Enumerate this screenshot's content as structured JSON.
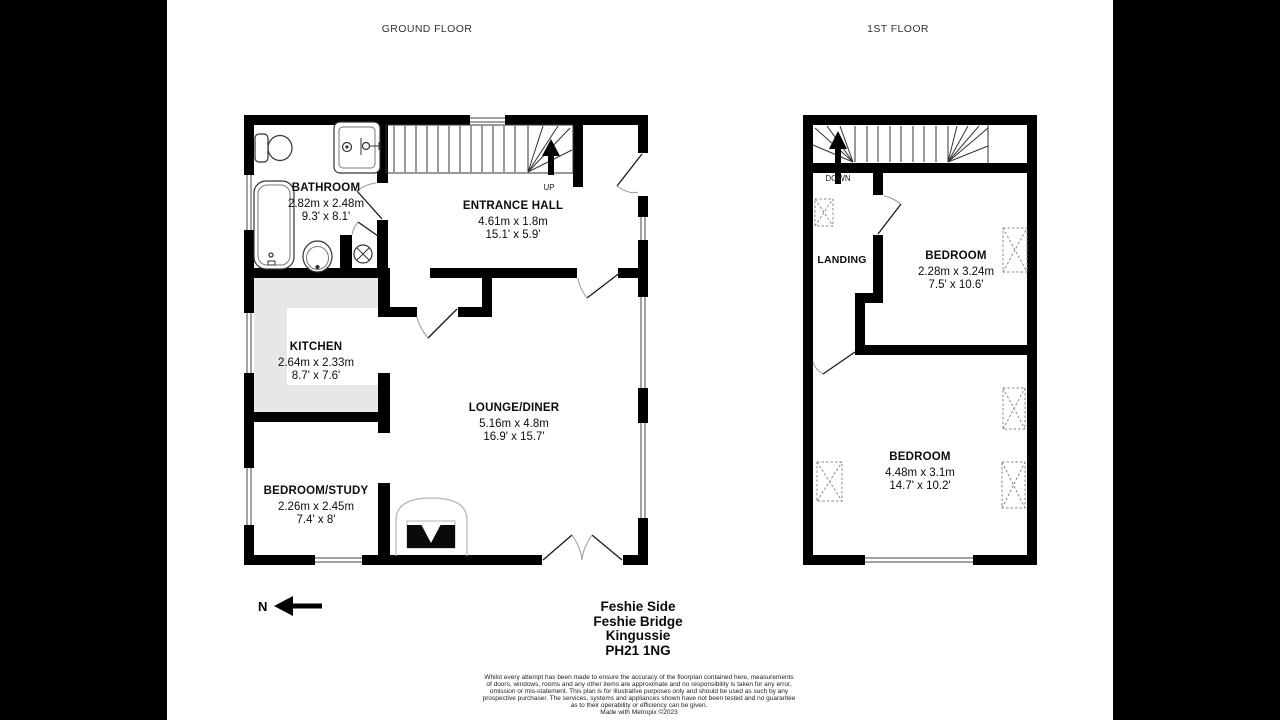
{
  "page": {
    "floor_titles": {
      "ground": "GROUND FLOOR",
      "first": "1ST FLOOR"
    },
    "north_label": "N",
    "address_lines": [
      "Feshie Side",
      "Feshie Bridge",
      "Kingussie",
      "PH21 1NG"
    ],
    "disclaimer_lines": [
      "Whilst every attempt has been made to ensure the accuracy of the floorplan contained here, measurements",
      "of doors, windows, rooms and any other items are approximate and no responsibility is taken for any error,",
      "omission or mis-statement. This plan is for illustrative purposes only and should be used as such by any",
      "prospective purchaser. The services, systems and appliances shown have not been tested and no guarantee",
      "as to their operability or efficiency can be given.",
      "Made with Metropix ©2023"
    ]
  },
  "ground_floor": {
    "stair_label": "UP",
    "rooms": [
      {
        "name": "BATHROOM",
        "metric": "2.82m x 2.48m",
        "imperial": "9.3' x 8.1'"
      },
      {
        "name": "ENTRANCE HALL",
        "metric": "4.61m x 1.8m",
        "imperial": "15.1' x 5.9'"
      },
      {
        "name": "KITCHEN",
        "metric": "2.64m x 2.33m",
        "imperial": "8.7' x 7.6'"
      },
      {
        "name": "LOUNGE/DINER",
        "metric": "5.16m x 4.8m",
        "imperial": "16.9' x 15.7'"
      },
      {
        "name": "BEDROOM/STUDY",
        "metric": "2.26m x 2.45m",
        "imperial": "7.4' x 8'"
      }
    ]
  },
  "first_floor": {
    "stair_label": "DOWN",
    "rooms": [
      {
        "name": "LANDING"
      },
      {
        "name": "BEDROOM",
        "metric": "2.28m x 3.24m",
        "imperial": "7.5' x 10.6'"
      },
      {
        "name": "BEDROOM",
        "metric": "4.48m x 3.1m",
        "imperial": "14.7' x 10.2'"
      }
    ]
  },
  "colors": {
    "wall": "#000000",
    "kitchen_floor": "#e7e7e7",
    "paper": "#ffffff",
    "background": "#000000"
  }
}
